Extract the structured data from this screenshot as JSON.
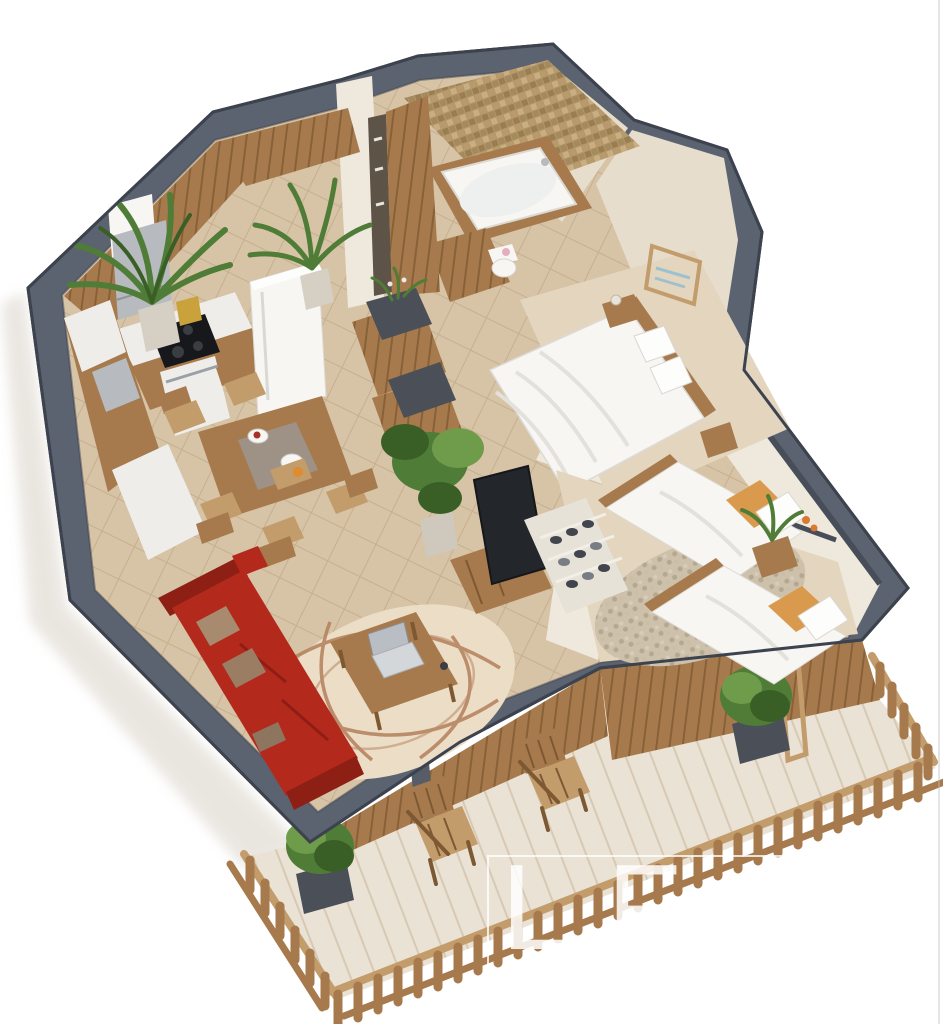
{
  "canvas": {
    "width": 943,
    "height": 1024,
    "background": "#ffffff"
  },
  "watermark": {
    "letters": [
      "L",
      "F",
      "C",
      "I"
    ],
    "frame_visible": true
  },
  "palette": {
    "wallTop": "#5c6370",
    "wallSide": "#454b57",
    "wallEdge": "#3c424d",
    "floor": "#d7c3a5",
    "floorLine": "#b29678",
    "carpet": "#e4d5bf",
    "pebble": "#cdc1ab",
    "innerWall": "#efe9dd",
    "innerShade": "#e6ddcd",
    "cap": "#474e59",
    "wood": "#a67a4c",
    "woodL": "#c39c6c",
    "woodD": "#7d5933",
    "slatLine": "#6e4d28",
    "deck": "#eae2d4",
    "deckLine": "#b49a76",
    "mosaic": "#b3976a",
    "white": "#f7f6f3",
    "appliance": "#efedea",
    "steel": "#b7babe",
    "tub": "#f8f7f4",
    "sofaRed": "#b32a1d",
    "sofaRedD": "#8e1f14",
    "pillowTaupe": "#a88a6f",
    "plantGreen": "#4f7c36",
    "plantGreenD": "#3a5f26",
    "plantGreenL": "#6f9c4b",
    "tvBlack": "#23262b",
    "rugCream": "#ecddc6",
    "rugLine": "#b3805a",
    "potGray": "#4a4f58",
    "shadow": "#d5cec2"
  },
  "scene": {
    "type": "3d-apartment-floor-plan",
    "rooms": [
      "kitchen",
      "dining-area",
      "hallway",
      "wardrobe",
      "bathroom",
      "master-bedroom",
      "second-bedroom",
      "living-room",
      "balcony"
    ]
  }
}
